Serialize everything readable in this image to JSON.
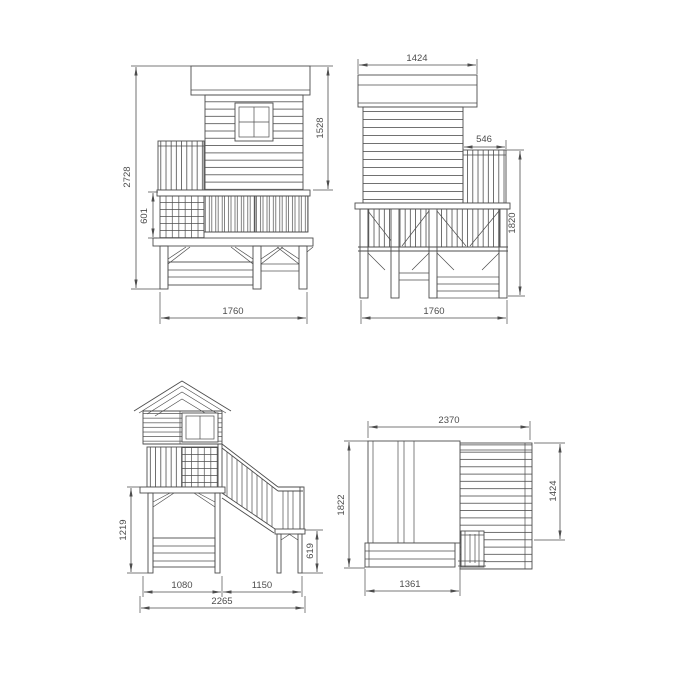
{
  "style": {
    "background": "#ffffff",
    "line_color": "#4d4d4d",
    "text_color": "#4d4d4d"
  },
  "views": {
    "side_elevation": {
      "dims": {
        "total_height": "2728",
        "railing_height": "601",
        "house_height": "1528",
        "width": "1760"
      }
    },
    "rear_elevation": {
      "dims": {
        "roof_width": "1424",
        "side_railing_width": "546",
        "height": "1820",
        "width": "1760"
      }
    },
    "front_elevation": {
      "dims": {
        "understructure_height": "1219",
        "landing_height": "619",
        "house_section_width": "1080",
        "stair_section_width": "1150",
        "total_width": "2265"
      }
    },
    "plan_view": {
      "dims": {
        "total_width": "2370",
        "total_depth": "1822",
        "deck_depth": "1424",
        "house_depth": "1361"
      }
    }
  }
}
